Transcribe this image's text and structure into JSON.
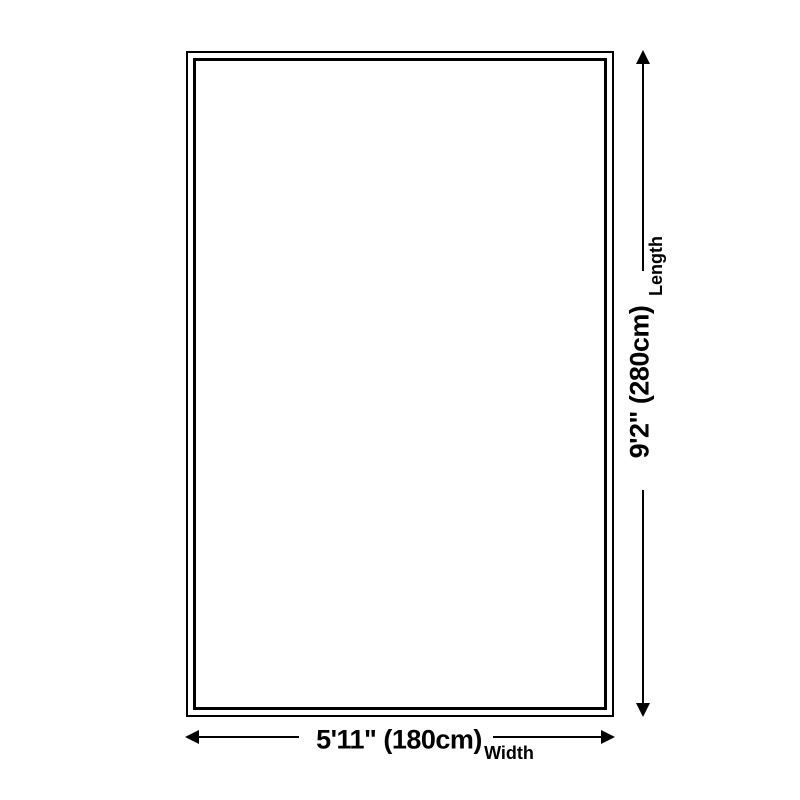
{
  "diagram": {
    "type": "product-size-diagram",
    "colors": {
      "background": "#ffffff",
      "line": "#000000",
      "text": "#000000"
    },
    "length": {
      "value": "9'2\" (280cm)",
      "label": "Length"
    },
    "width": {
      "value": "5'11\" (180cm)",
      "label": "Width"
    }
  }
}
